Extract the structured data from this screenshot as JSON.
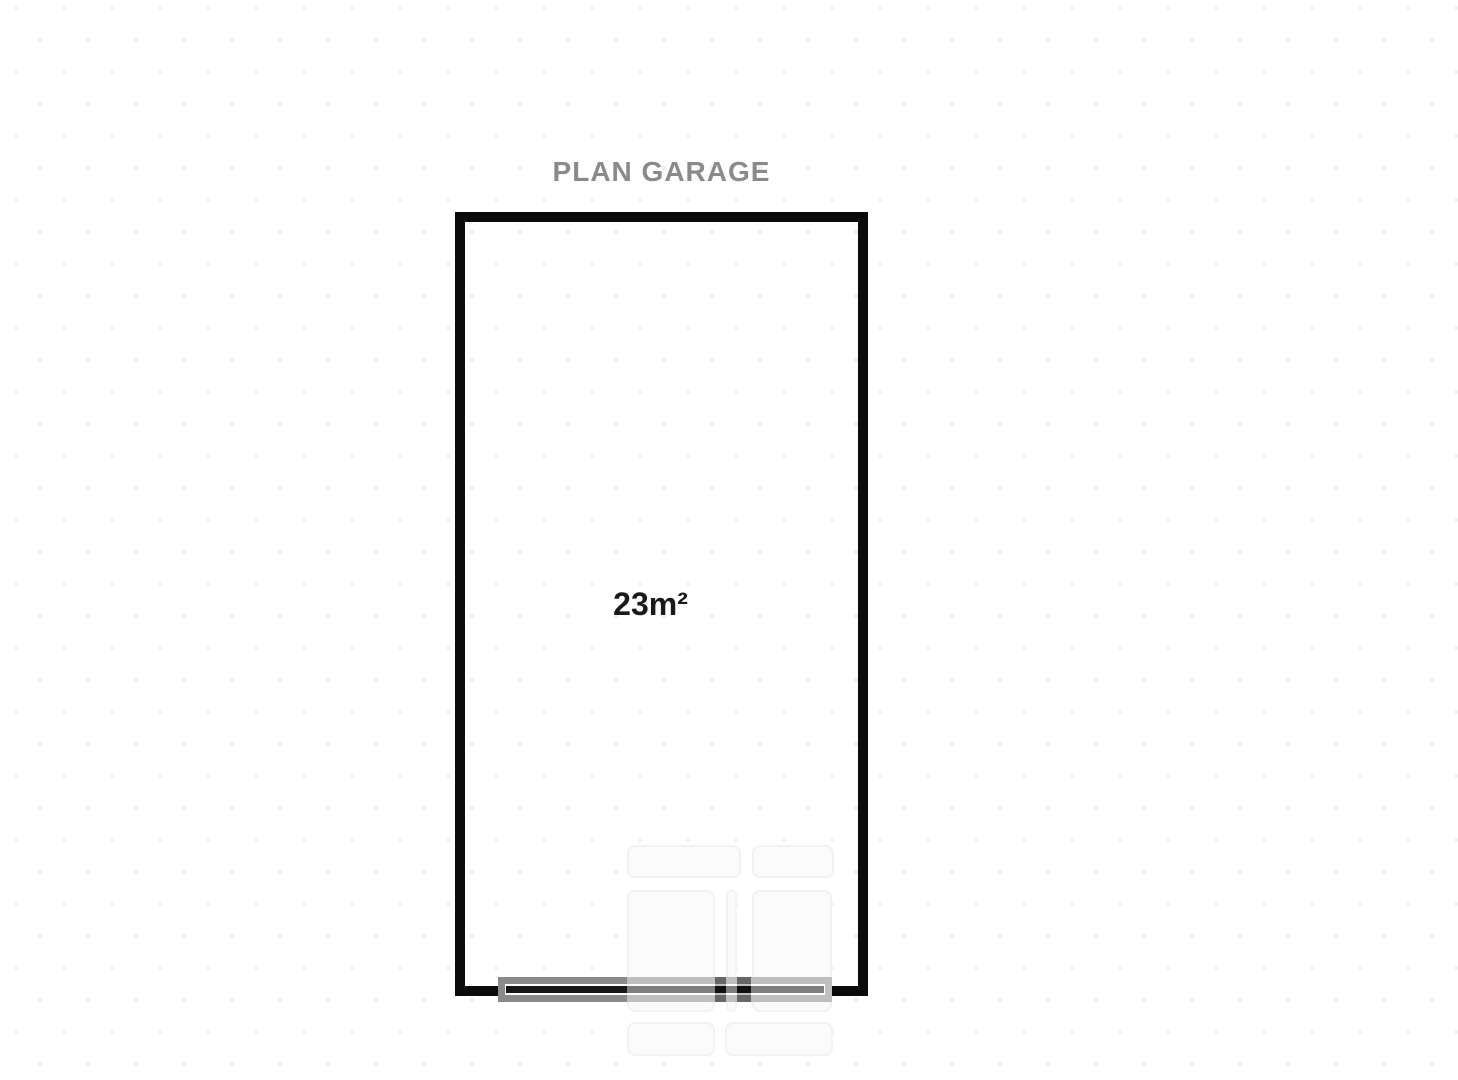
{
  "plan": {
    "title": "PLAN GARAGE",
    "title_color": "#8a8a8a",
    "area_label": "23m²",
    "wall_color": "#0b0b0b",
    "door_color": "#8a8a8a",
    "watermark_color": "#f7f7f7"
  }
}
